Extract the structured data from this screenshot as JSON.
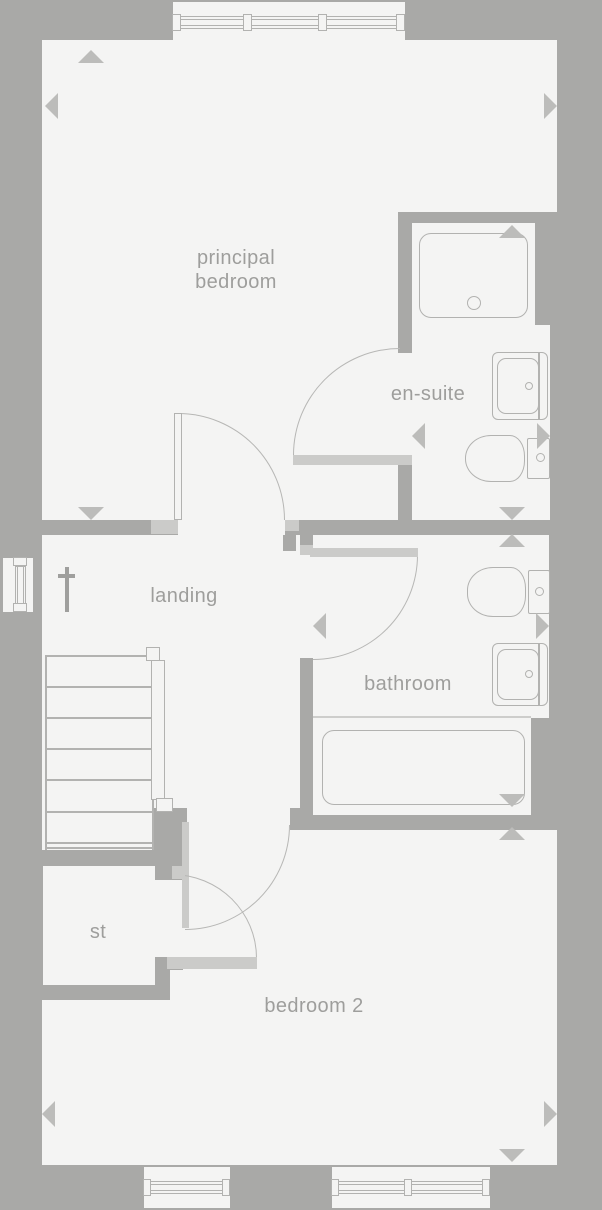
{
  "labels": {
    "principal_bedroom": "principal\nbedroom",
    "en_suite": "en-suite",
    "landing": "landing",
    "bathroom": "bathroom",
    "st": "st",
    "bedroom_2": "bedroom 2"
  },
  "colors": {
    "wall": "#a9a9a7",
    "floor": "#f4f4f3",
    "accent": "#cbcbc9",
    "line": "#b2b2b0",
    "arrow": "#bcbcba",
    "text": "#9e9e9c",
    "symbol": "#9f9f9d"
  },
  "rooms": [
    {
      "name": "principal bedroom"
    },
    {
      "name": "en-suite"
    },
    {
      "name": "landing"
    },
    {
      "name": "bathroom"
    },
    {
      "name": "st"
    },
    {
      "name": "bedroom 2"
    }
  ],
  "fixtures": [
    {
      "name": "shower-tray",
      "room": "en-suite"
    },
    {
      "name": "basin",
      "room": "en-suite"
    },
    {
      "name": "toilet",
      "room": "en-suite"
    },
    {
      "name": "toilet",
      "room": "bathroom"
    },
    {
      "name": "basin",
      "room": "bathroom"
    },
    {
      "name": "bath",
      "room": "bathroom"
    },
    {
      "name": "stairs",
      "room": "landing",
      "treads": 7
    },
    {
      "name": "handrail",
      "room": "landing"
    }
  ],
  "doors": [
    {
      "room": "principal bedroom",
      "type": "quarter-swing"
    },
    {
      "room": "en-suite",
      "type": "quarter-swing"
    },
    {
      "room": "bathroom",
      "type": "quarter-swing"
    },
    {
      "room": "bedroom 2",
      "type": "quarter-swing"
    },
    {
      "room": "st",
      "type": "quarter-swing"
    }
  ],
  "windows": [
    {
      "wall": "top",
      "panes": 3
    },
    {
      "wall": "left",
      "panes": 1
    },
    {
      "wall": "bottom-left",
      "panes": 1
    },
    {
      "wall": "bottom-right",
      "panes": 2
    }
  ],
  "symbols": [
    {
      "name": "dagger-marker",
      "room": "landing"
    }
  ],
  "arrows": {
    "count": 16,
    "style": "dimension-pointer"
  }
}
